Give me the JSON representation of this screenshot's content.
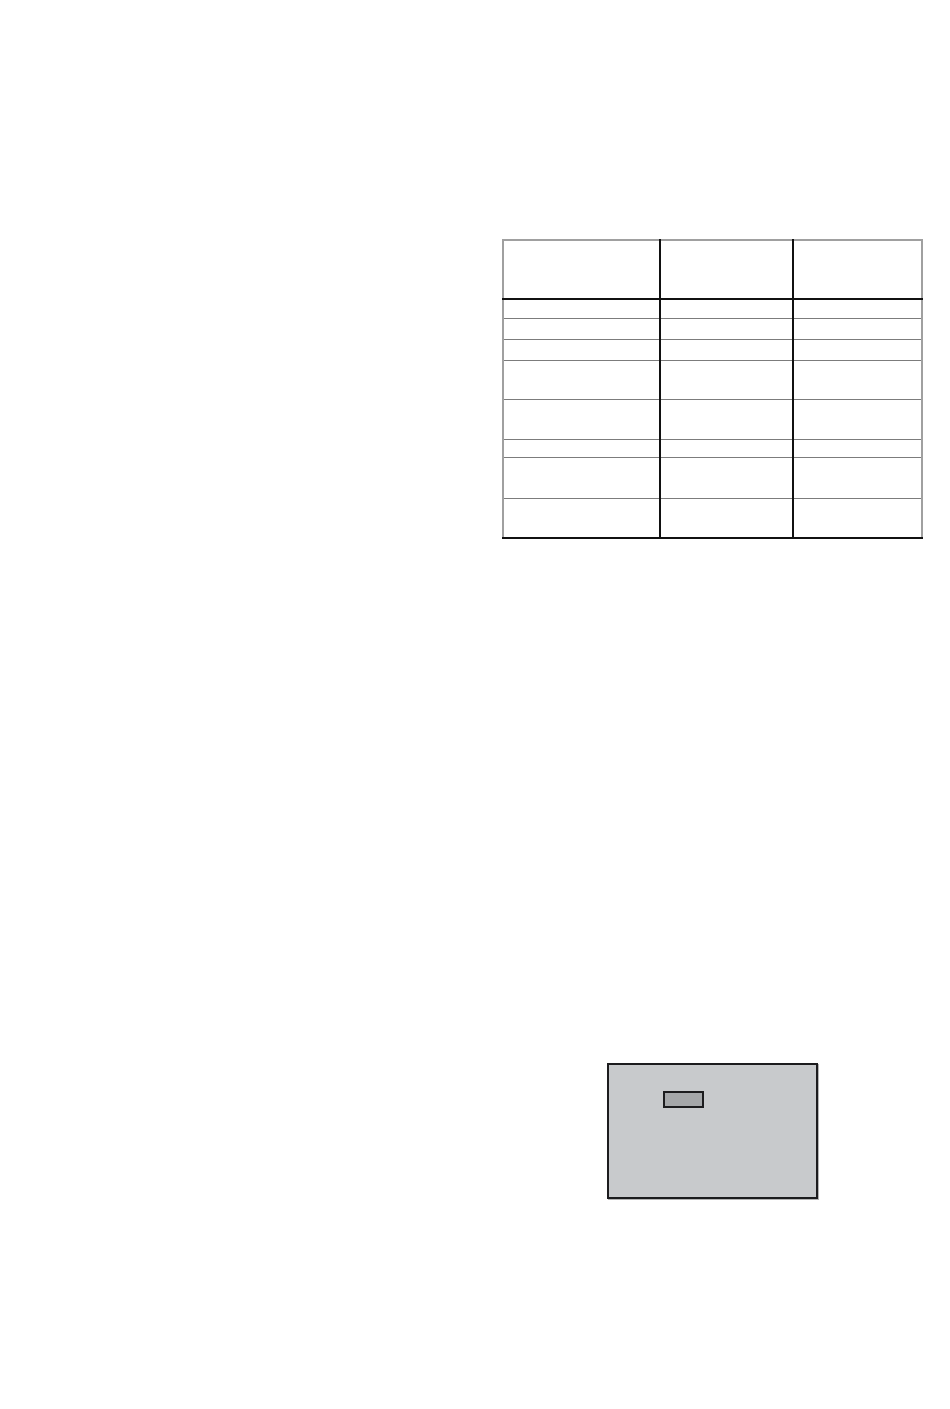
{
  "colors": {
    "page_background": "#ffffff",
    "table_outer_border": "#a0a0a0",
    "table_grid": "#7c7c7c",
    "table_divider": "#111111",
    "panel_fill": "#c8cacc",
    "panel_border": "#1c1c1e",
    "button_fill": "#a5a7a9",
    "button_border": "#1c1c1e"
  },
  "table": {
    "column_count": 3,
    "row_count": 9,
    "headers": [
      "",
      "",
      ""
    ],
    "rows": [
      [
        "",
        "",
        ""
      ],
      [
        "",
        "",
        ""
      ],
      [
        "",
        "",
        ""
      ],
      [
        "",
        "",
        ""
      ],
      [
        "",
        "",
        ""
      ],
      [
        "",
        "",
        ""
      ],
      [
        "",
        "",
        ""
      ],
      [
        "",
        "",
        ""
      ]
    ]
  },
  "figure": {
    "panel_label": "",
    "display_label": ""
  }
}
